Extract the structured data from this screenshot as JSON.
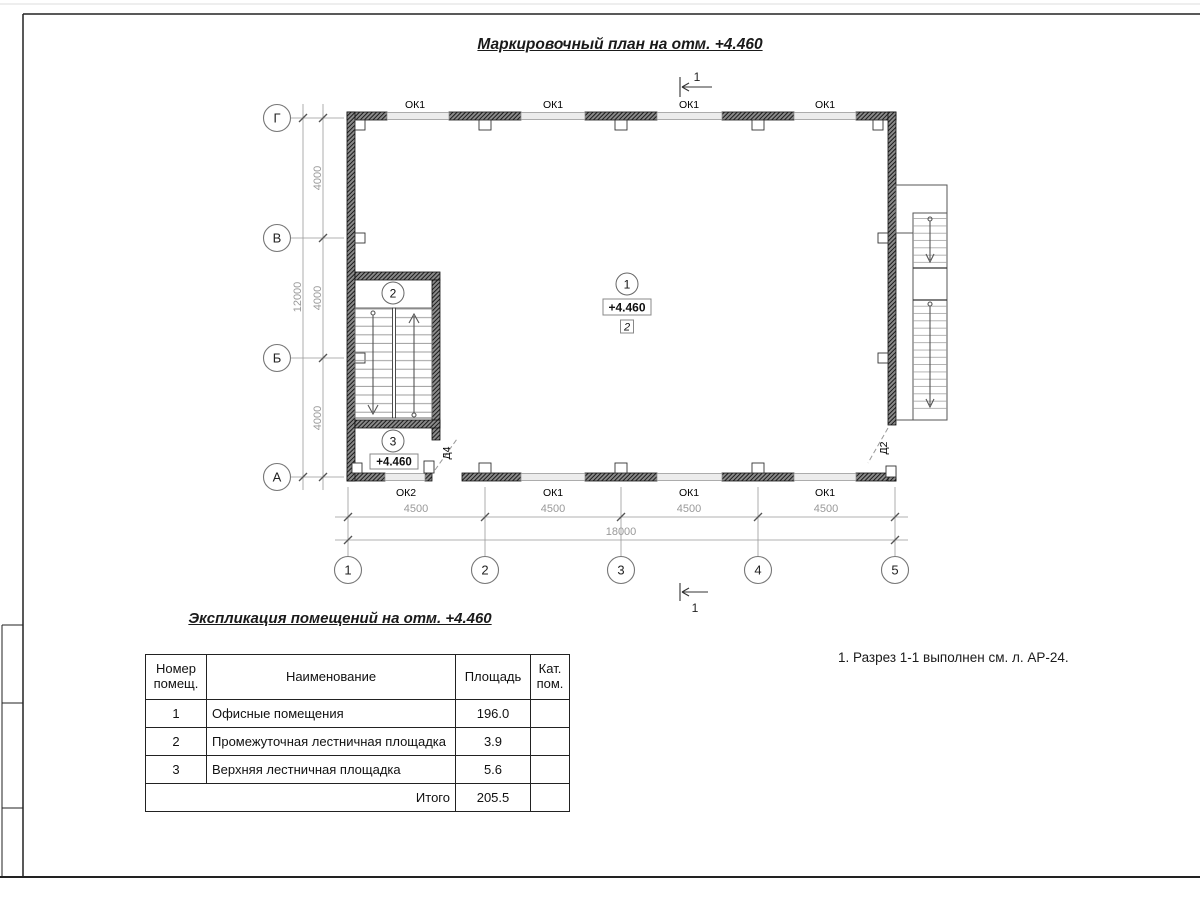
{
  "drawing_title": "Маркировочный план на отм. +4.460",
  "plan": {
    "grid": {
      "rows": [
        "Г",
        "В",
        "Б",
        "А"
      ],
      "cols": [
        "1",
        "2",
        "3",
        "4",
        "5"
      ]
    },
    "dims": {
      "h": [
        "4500",
        "4500",
        "4500",
        "4500"
      ],
      "h_total": "18000",
      "v": [
        "4000",
        "4000",
        "4000"
      ],
      "v_total": "12000"
    },
    "windows_top": [
      "ОК1",
      "ОК1",
      "ОК1",
      "ОК1"
    ],
    "windows_bottom": [
      "ОК2",
      "ОК1",
      "ОК1",
      "ОК1"
    ],
    "doors": {
      "d4": "Д4",
      "d2": "Д2"
    },
    "rooms": {
      "r1": {
        "num": "1",
        "elev": "+4.460",
        "cat": "2"
      },
      "r2": {
        "num": "2"
      },
      "r3": {
        "num": "3",
        "elev": "+4.460"
      }
    },
    "section": {
      "top": "1",
      "bottom": "1"
    }
  },
  "explication": {
    "title": "Экспликация помещений на отм. +4.460",
    "headers": {
      "num": "Номер помещ.",
      "name": "Наименование",
      "area": "Площадь",
      "cat": "Кат. пом."
    },
    "rows": [
      {
        "num": "1",
        "name": "Офисные помещения",
        "area": "196.0",
        "cat": ""
      },
      {
        "num": "2",
        "name": "Промежуточная лестничная площадка",
        "area": "3.9",
        "cat": ""
      },
      {
        "num": "3",
        "name": "Верхняя лестничная площадка",
        "area": "5.6",
        "cat": ""
      }
    ],
    "total_label": "Итого",
    "total_value": "205.5"
  },
  "notes": [
    "1. Разрез 1-1 выполнен см. л. АР-24."
  ]
}
